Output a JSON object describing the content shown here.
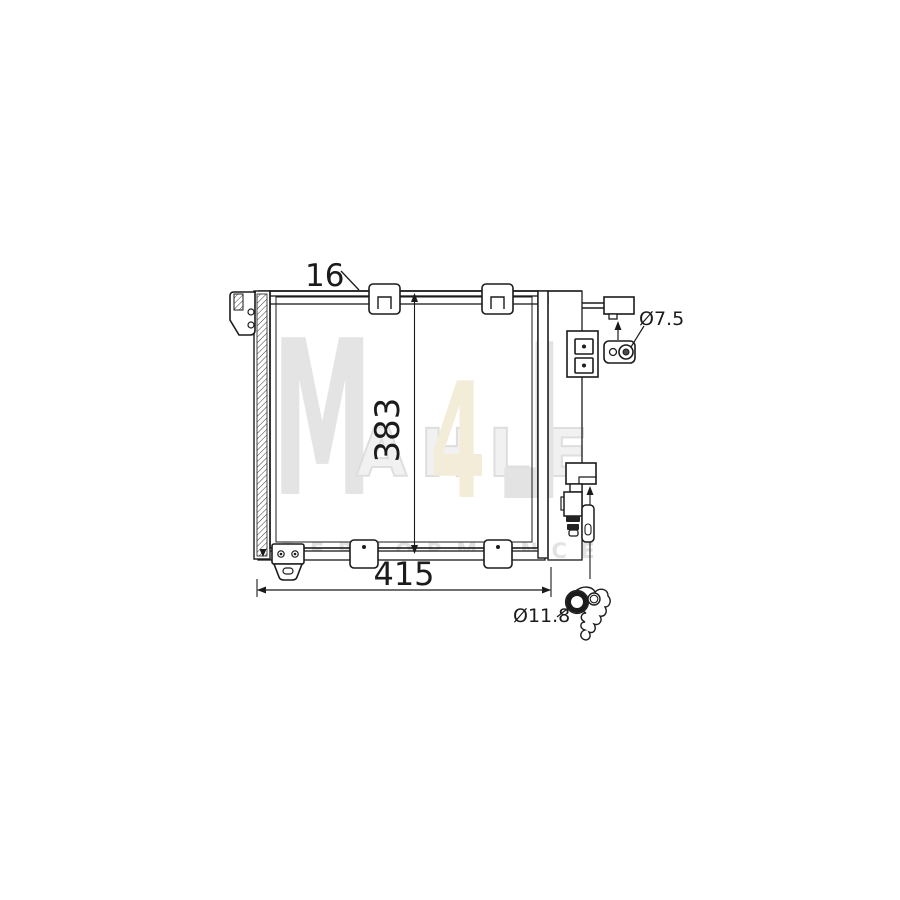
{
  "drawing": {
    "description": "Technical line drawing of an air conditioning condenser, front view, with mounting brackets, receiver drier, pressure valve and pipe fittings"
  },
  "labels": {
    "depth": "16",
    "height": "383",
    "width": "415",
    "bracket_hole_diameter": "Ø7.5",
    "fitting_diameter": "Ø11.8"
  },
  "watermark": {
    "letter_m": "M",
    "letter_a": "4",
    "band": "AHLE",
    "letter_l": "L",
    "tagline": "PERFORMANCE",
    "gray": "#e4e4e4",
    "yellow": "#f2ecd9"
  },
  "colors": {
    "line": "#1b1b1b",
    "background": "#ffffff"
  }
}
